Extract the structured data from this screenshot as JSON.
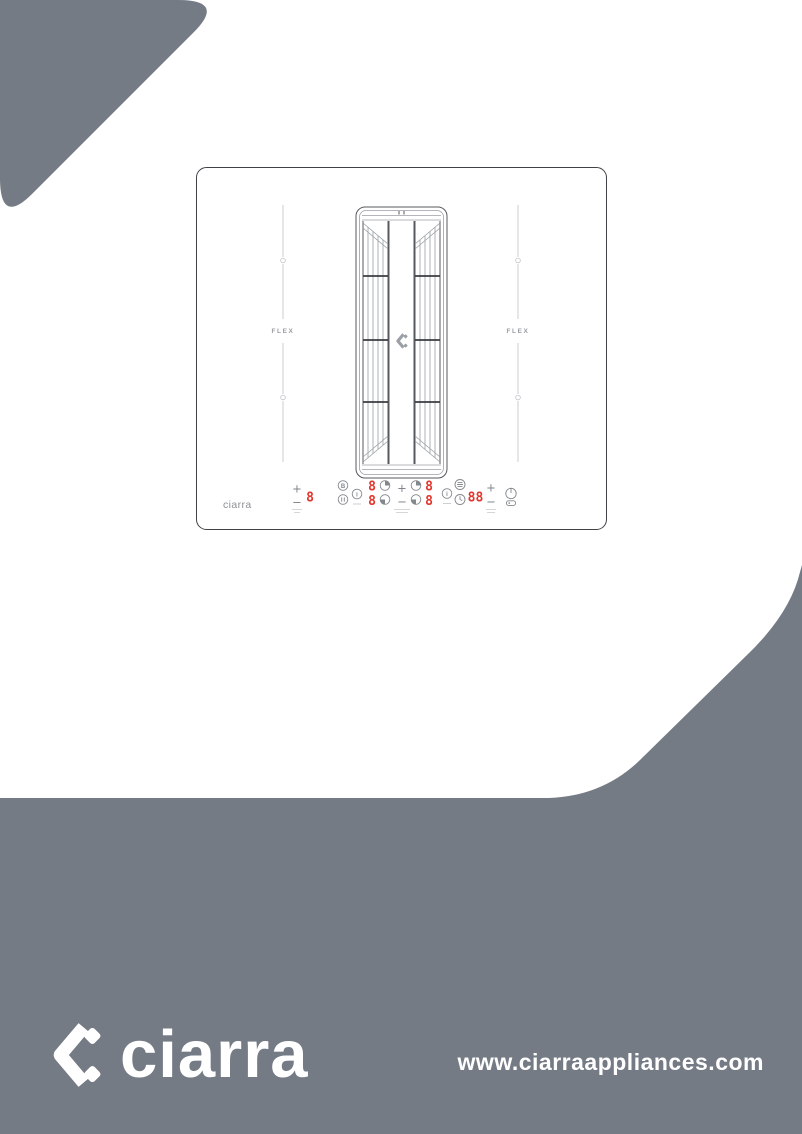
{
  "colors": {
    "page_gray": "#757b85",
    "display_red": "#e2362c",
    "drawing_line_gray": "#9aa0a5",
    "drawing_line_dark": "#55595e",
    "control_gray": "#83888d",
    "white": "#ffffff"
  },
  "hob": {
    "brand_label": "ciarra",
    "flex_left_label": "FLEX",
    "flex_right_label": "FLEX",
    "controls": {
      "plus": "+",
      "minus": "−",
      "boost_glyph": "B",
      "info_glyph": "i",
      "displays": {
        "zone_left": "8",
        "left_top": "8",
        "left_bottom": "8",
        "right_top": "8",
        "right_bottom": "8",
        "timer": "88"
      },
      "icons": [
        "boost-icon",
        "pause-icon",
        "info-icon",
        "heat-level-icon",
        "fan-icon",
        "clock-icon",
        "power-icon",
        "key-lock-icon"
      ]
    }
  },
  "footer": {
    "logo_text": "ciarra",
    "website": "www.ciarraappliances.com"
  }
}
